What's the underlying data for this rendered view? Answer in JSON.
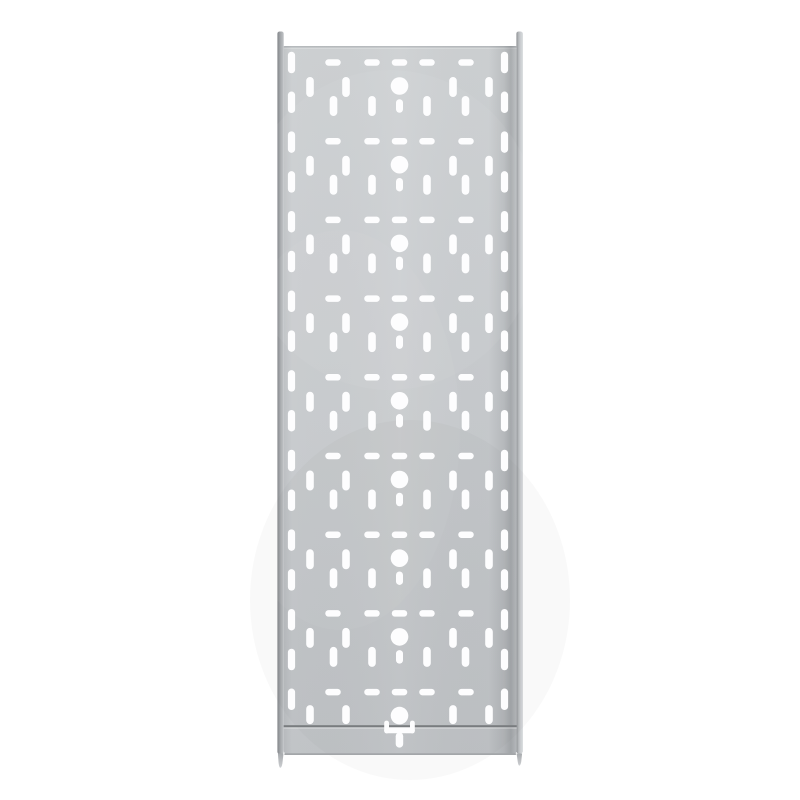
{
  "meta": {
    "alt": "Product image: straight perforated cable tray section in galvanised steel, viewed flat on a white background"
  },
  "colors": {
    "background": "#ffffff",
    "surface_top": "#cdd0d2",
    "surface_mid": "#c8cbce",
    "surface_bottom": "#c1c4c7",
    "top_edge_line": "#b4b7ba",
    "seam_line": "#797c7f",
    "bottom_edge_line": "#a3a6a9",
    "rail_left_dark": "#83868a",
    "rail_left_mid": "#a6a9ac",
    "rail_left_light": "#c0c3c6",
    "rail_right_dark": "#8d9093",
    "rail_right_mid": "#b7babd",
    "rail_right_light": "#d3d6d9",
    "rail_right_end": "#c6c9cc",
    "prong_top": "#a8abae",
    "prong_bottom": "#ccced1",
    "hole": "#fdfdfe"
  },
  "pattern": {
    "center_x": 399.5,
    "tiles": {
      "first_cy": 86,
      "pitch": 78.7,
      "count": 9
    },
    "circle": {
      "r": 8.8
    },
    "dash": {
      "w": 15.5,
      "h": 6.5,
      "dy": -23.5,
      "offsets": [
        -66.5,
        -27.5,
        0,
        27.5,
        66.5
      ]
    },
    "slot_upper": {
      "w": 7.6,
      "h": 20,
      "dy": 1,
      "h_last": 19,
      "dy_last": -1,
      "offsets": [
        -89.5,
        -53.5,
        53.5,
        89.5
      ]
    },
    "slot_lower": {
      "w": 7.6,
      "h": 20,
      "dy": 20,
      "offsets": [
        -66,
        -27.5,
        27.5,
        66
      ]
    },
    "slot_short": {
      "w": 7,
      "h": 13.5,
      "dy": 20
    },
    "margin_slots": {
      "w": 7.2,
      "h": 21.5,
      "first_cy": 62.5,
      "pitch": 39.8,
      "count": 17,
      "x_left": 291.5,
      "x_right": 504.5
    },
    "t_cutout": {
      "rects": [
        {
          "x": 384.2,
          "y": 720.6,
          "w": 4.8,
          "h": 12.8,
          "rx": 2.4
        },
        {
          "x": 410.0,
          "y": 720.6,
          "w": 4.8,
          "h": 12.8,
          "rx": 2.4
        },
        {
          "x": 384.2,
          "y": 727.4,
          "w": 30.6,
          "h": 5.9,
          "rx": 2.9
        },
        {
          "x": 395.7,
          "y": 732.4,
          "w": 7.5,
          "h": 15.2,
          "rx": 3.7
        }
      ]
    }
  }
}
